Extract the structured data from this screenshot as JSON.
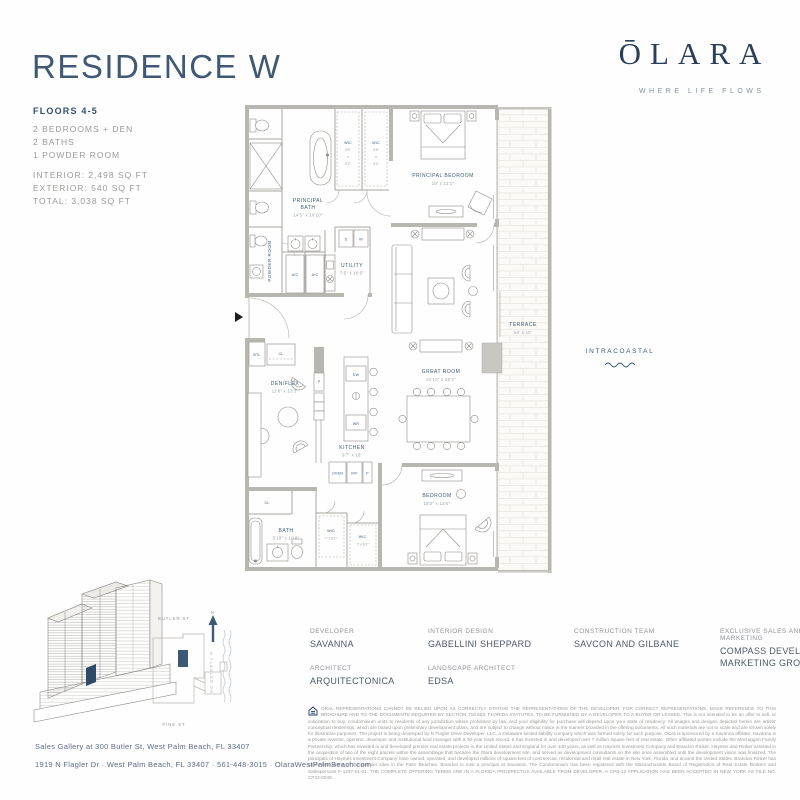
{
  "header": {
    "title": "RESIDENCE W",
    "floors": "FLOORS 4-5",
    "features": [
      "2 BEDROOMS + DEN",
      "2 BATHS",
      "1 POWDER ROOM"
    ],
    "areas": [
      "INTERIOR: 2,498 SQ FT",
      "EXTERIOR: 540 SQ FT",
      "TOTAL: 3,038 SQ FT"
    ]
  },
  "brand": {
    "logo": "ŌLARA",
    "tagline": "WHERE LIFE FLOWS"
  },
  "floorplan": {
    "principal_bath": {
      "name1": "PRINCIPAL",
      "name2": "BATH",
      "dims": "14'5\" x 10'10\""
    },
    "wic_small": {
      "lines": [
        "WIC",
        "4'9\"",
        "x",
        "9'2\""
      ]
    },
    "principal_bedroom": {
      "name": "PRINCIPAL BEDROOM",
      "dims": "18' x 13'1\""
    },
    "powder_room": "POWDER ROOM",
    "utility": {
      "name": "UTILITY",
      "dims": "7'5\" x 10'5\""
    },
    "ac": "A/C",
    "dryer": "D",
    "washer": "W",
    "btl": "BTL",
    "closet": "CL",
    "den": {
      "name": "DEN/FLEX",
      "dims": "11'8\" x 13'3\""
    },
    "kitchen": {
      "name": "KITCHEN",
      "dims": "9'7\" x 16'"
    },
    "dw": "DW",
    "wr": "WR",
    "pantry": "P",
    "oven": "OVEN",
    "rf": "R/F",
    "great_room": {
      "name": "GREAT ROOM",
      "dims": "21'10\" x 26'2\""
    },
    "terrace": {
      "name": "TERRACE",
      "dims": "54' x 10'"
    },
    "bath2": {
      "name": "BATH",
      "dims": "5'10\" x 10'8\""
    },
    "wic_big": {
      "name": "WIC",
      "dims": "7' x 6'1\""
    },
    "bedroom2": {
      "name": "BEDROOM",
      "dims": "18'2\" x 12'0\""
    },
    "intracoastal": "INTRACOASTAL"
  },
  "sitemap": {
    "street_top": "BUTLER ST",
    "street_bottom": "PINE ST",
    "street_right": "N FLAGLER DR",
    "north": "N"
  },
  "credits": {
    "col1": [
      {
        "role": "DEVELOPER",
        "name": "SAVANNA"
      },
      {
        "role": "ARCHITECT",
        "name": "ARQUITECTONICA"
      }
    ],
    "col2": [
      {
        "role": "INTERIOR DESIGN",
        "name": "GABELLINI SHEPPARD"
      },
      {
        "role": "LANDSCAPE ARCHITECT",
        "name": "EDSA"
      }
    ],
    "col3": [
      {
        "role": "CONSTRUCTION TEAM",
        "name": "SAVCON AND GILBANE"
      }
    ],
    "col4": [
      {
        "role": "EXCLUSIVE SALES AND MARKETING",
        "name": "COMPASS DEVELOPMENT MARKETING GROUP"
      }
    ]
  },
  "footer": {
    "address1": "Sales Gallery at 300 Butler St, West Palm Beach, FL 33407",
    "address2": "1919 N Flagler Dr  ·  West Palm Beach, FL 33407  ·  561-448-3015  ·  OlaraWestPalmBeach.com",
    "disclaimer": "ORAL REPRESENTATIONS CANNOT BE RELIED UPON AS CORRECTLY STATING THE REPRESENTATIONS OF THE DEVELOPER. FOR CORRECT REPRESENTATIONS, MAKE REFERENCE TO THIS BROCHURE AND TO THE DOCUMENTS REQUIRED BY SECTION 718.503, FLORIDA STATUTES, TO BE FURNISHED BY A DEVELOPER TO A BUYER OR LESSEE. This is not intended to be an offer to sell, or solicitation to buy, condominium units to residents of any jurisdiction where prohibited by law, and your eligibility for purchase will depend upon your state of residency. All images and designs depicted herein are artists' conceptual renderings, which are based upon preliminary development plans, and are subject to change without notice in the manner provided in the offering documents. All such materials are not to scale and are shown solely for illustrative purposes. The project is being developed by N Flagler Drive Developer, LLC, a Delaware limited liability company which was formed solely for such purpose. Olara is sponsored by a Savanna affiliate. Savanna is a private investor, operator, developer and institutional fund manager with a 30-year track record. It has invested in and developed over 7 million square feet of real estate. Other affiliated parties include the Mactaggart Family Partnership, which has invested in and developed premier real estate projects in the United States and England for over 100 years, as well as Haymes Investment Company and Brandon Rinker. Haymes and Rinker assisted in the acquisition of two of the eight parcels within the assemblage that became the Olara development site, and served as development consultants on the site once assembled until the development vision was finalized. The principals of Haymes Investment Company have owned, operated, and developed millions of square feet of commercial, residential and retail real estate in New York, Florida, and around the United States. Brandon Rinker has assembled some of the premier sites in the Palm Beaches. Brandon is now a principal at Savanna. The Condominium has been registered with the Massachusetts Board of Registration of Real Estate Brokers and Salespersons F-1237-01-01. THE COMPLETE OFFERING TERMS ARE IN A FLORIDA PROSPECTUS AVAILABLE FROM DEVELOPER. A CPS-12 APPLICATION HAS BEEN ACCEPTED IN NEW YORK AS FILE NO. CP22-0049."
  }
}
